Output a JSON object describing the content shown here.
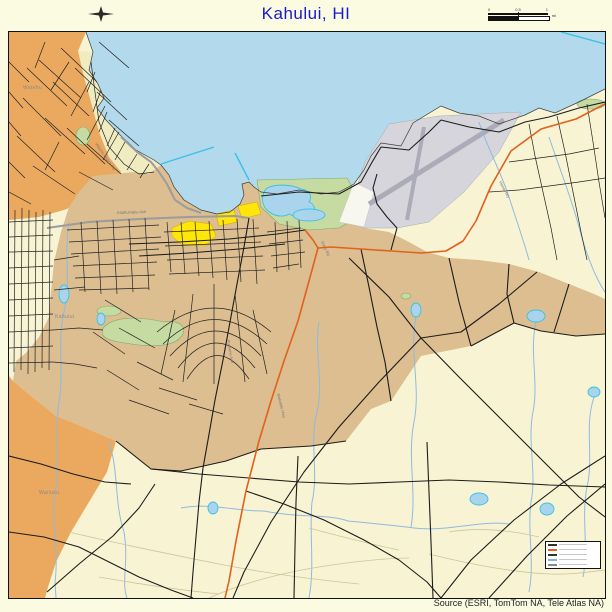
{
  "header": {
    "title": "Kahului, HI"
  },
  "footer": {
    "source": "Source (ESRI, TomTom NA, Tele Atlas NA)"
  },
  "scalebar": {
    "ticks": [
      "0",
      "0.5",
      "1"
    ],
    "unit_top": "mi",
    "unit_bottom": "km"
  },
  "place_labels": {
    "waiehu": "Waiehu",
    "kahului": "Kahului",
    "wailuku": "Wailuku"
  },
  "road_labels": {
    "hana": "Hana Hwy",
    "mokulele": "Mokulele Hwy",
    "puunene": "Puunene Ave",
    "kaahumanu": "Kaahumanu Ave",
    "dairy": "Dairy Rd",
    "waiehu_beach": "Waiehu Beach Rd"
  },
  "colors": {
    "background_cream": "#FBFBE2",
    "land": "#F8F4D3",
    "ocean": "#B3DAEC",
    "coastal_strip": "#F1ECC0",
    "kahului_cdp_tan": "#DCBE90",
    "wailuku_cdp_orange": "#EAA95F",
    "commercial_yellow": "#FFE60A",
    "park_green": "#C5DBA2",
    "airport_gray": "#D6D5DC",
    "runway_gray": "#ACABB8",
    "highway_orange": "#E2611C",
    "road_black": "#1C1C1C",
    "road_gray": "#9C9C9C",
    "stream_blue": "#8FBADF",
    "water_fill": "#A9D4EC",
    "water_outline": "#3AC1E5",
    "title_blue": "#1A1ACD"
  },
  "legend": {
    "row_colors": [
      "#333333",
      "#E2611C",
      "#333333",
      "#7FB2DC",
      "#888888"
    ]
  }
}
